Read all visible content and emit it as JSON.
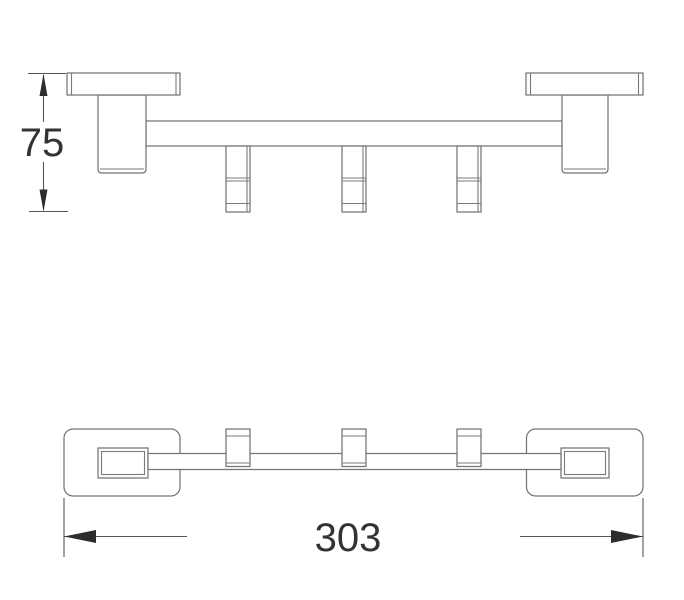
{
  "diagram": {
    "kind": "technical-dimension-drawing",
    "background": "#ffffff",
    "colors": {
      "part_outline": "#747474",
      "dimension_line": "#555555",
      "arrow": "#2d2d2d",
      "text": "#333333"
    },
    "views": {
      "side_view": {
        "hook_count": 3,
        "wall_plate_count": 2
      },
      "plan_view": {
        "hook_count": 3,
        "wall_plate_count": 2
      }
    },
    "dimensions": {
      "height": {
        "label": "75"
      },
      "length": {
        "label": "303"
      }
    }
  }
}
